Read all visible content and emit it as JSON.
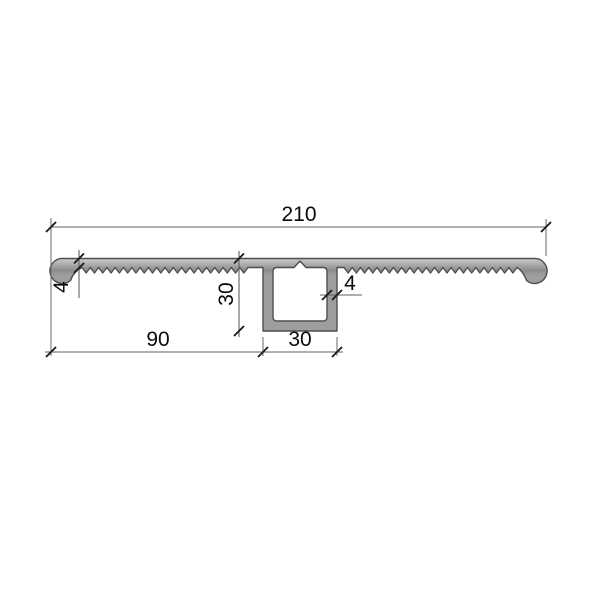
{
  "drawing": {
    "type": "technical-cross-section",
    "dim_total_width": "210",
    "dim_plate_thickness": "4",
    "dim_box_height": "30",
    "dim_wall_thickness": "4",
    "dim_left_span": "90",
    "dim_box_width": "30"
  },
  "colors": {
    "background": "#ffffff",
    "profile_fill_light": "#d6d6d6",
    "profile_fill_mid": "#9e9e9e",
    "profile_outline": "#4f4f4f",
    "dimension_lines": "#5f5f5f",
    "text": "#0a0a0a"
  }
}
